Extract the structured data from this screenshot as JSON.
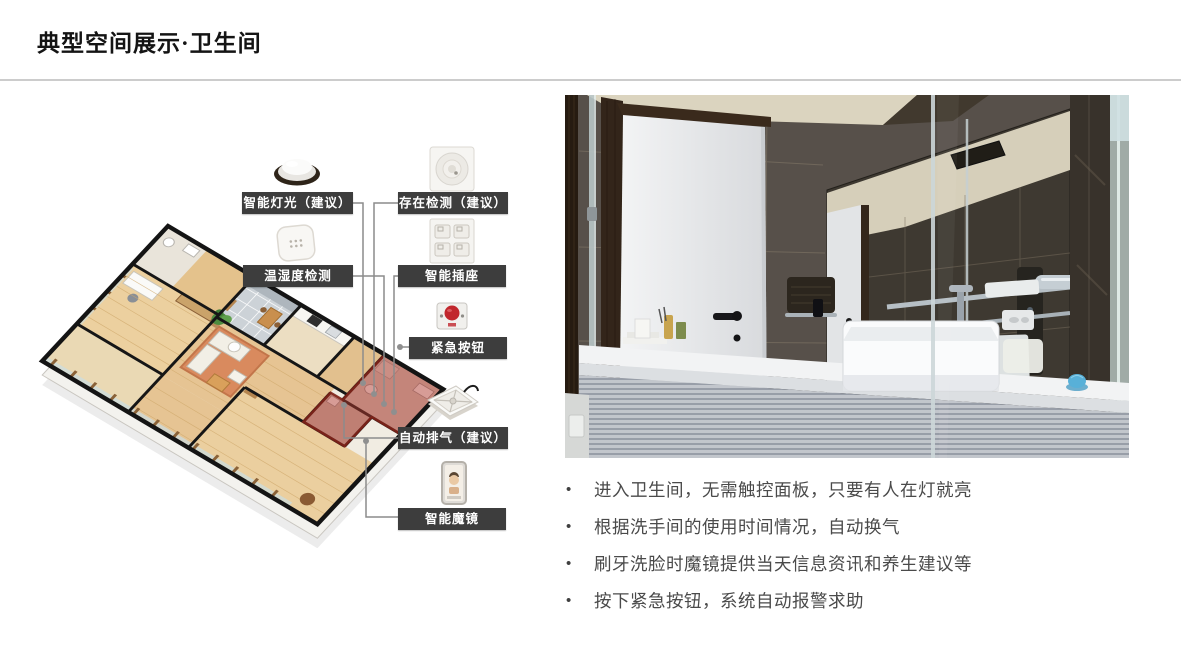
{
  "slide": {
    "title": "典型空间展示·卫生间",
    "background_color": "#ffffff",
    "title_color": "#141414",
    "divider_color": "#cccccc"
  },
  "diagram": {
    "description": "三维户型图，卫生间区域红色高亮，设备标签指向卫生间",
    "highlight_room_color": "#b03a2e",
    "label_bg_color": "#3d3d3d",
    "label_text_color": "#ffffff",
    "labels": [
      {
        "text": "智能灯光（建议）",
        "icon": "ceiling-light-icon"
      },
      {
        "text": "存在检测（建议）",
        "icon": "presence-sensor-icon"
      },
      {
        "text": "温湿度检测",
        "icon": "temp-humidity-sensor-icon"
      },
      {
        "text": "智能插座",
        "icon": "smart-socket-icon"
      },
      {
        "text": "紧急按钮",
        "icon": "emergency-button-icon"
      },
      {
        "text": "自动排气（建议）",
        "icon": "exhaust-fan-icon"
      },
      {
        "text": "智能魔镜",
        "icon": "smart-mirror-icon"
      }
    ]
  },
  "bullets": {
    "bullet_char": "•",
    "text_color": "#4a4a4a",
    "items": [
      "进入卫生间，无需触控面板，只要有人在灯就亮",
      "根据洗手间的使用时间情况，自动换气",
      "刷牙洗脸时魔镜提供当天信息资讯和养生建议等",
      "按下紧急按钮，系统自动报警求助"
    ]
  }
}
